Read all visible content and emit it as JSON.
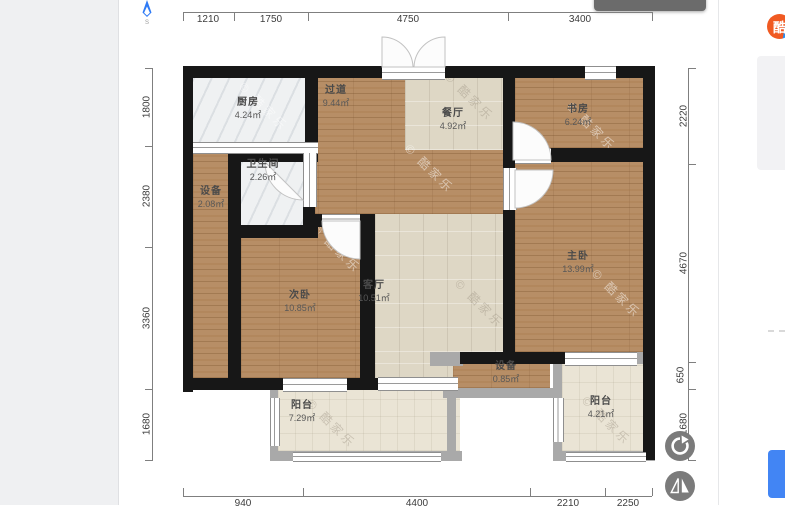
{
  "app": {
    "logo_char": "酷",
    "compass_label": "S",
    "watermark_full": "© 酷家乐"
  },
  "plan": {
    "rooms": [
      {
        "name": "厨房",
        "area": "4.24㎡"
      },
      {
        "name": "过道",
        "area": "9.44㎡"
      },
      {
        "name": "餐厅",
        "area": "4.92㎡"
      },
      {
        "name": "书房",
        "area": "6.24㎡"
      },
      {
        "name": "卫生间",
        "area": "2.26㎡"
      },
      {
        "name": "设备",
        "area": "2.08㎡"
      },
      {
        "name": "次卧",
        "area": "10.85㎡"
      },
      {
        "name": "客厅",
        "area": "10.51㎡"
      },
      {
        "name": "主卧",
        "area": "13.99㎡"
      },
      {
        "name": "设备",
        "area": "0.85㎡"
      },
      {
        "name": "阳台",
        "area": "7.29㎡"
      },
      {
        "name": "阳台",
        "area": "4.21㎡"
      }
    ],
    "dims": {
      "top": [
        "1210",
        "1750",
        "4750",
        "3400"
      ],
      "left": [
        "1800",
        "2380",
        "3360",
        "1680"
      ],
      "right": [
        "2220",
        "4670",
        "650",
        "1680"
      ],
      "bottom": [
        "940",
        "4400",
        "2210",
        "2250"
      ]
    }
  },
  "colors": {
    "accent_blue": "#4285f4",
    "logo_orange": "#f05a22",
    "wall_black": "#171717",
    "wood": "#b78e66",
    "tile": "#ded7c5",
    "balcony": "#eae4d5",
    "gray_wall": "#a9a9a9"
  }
}
